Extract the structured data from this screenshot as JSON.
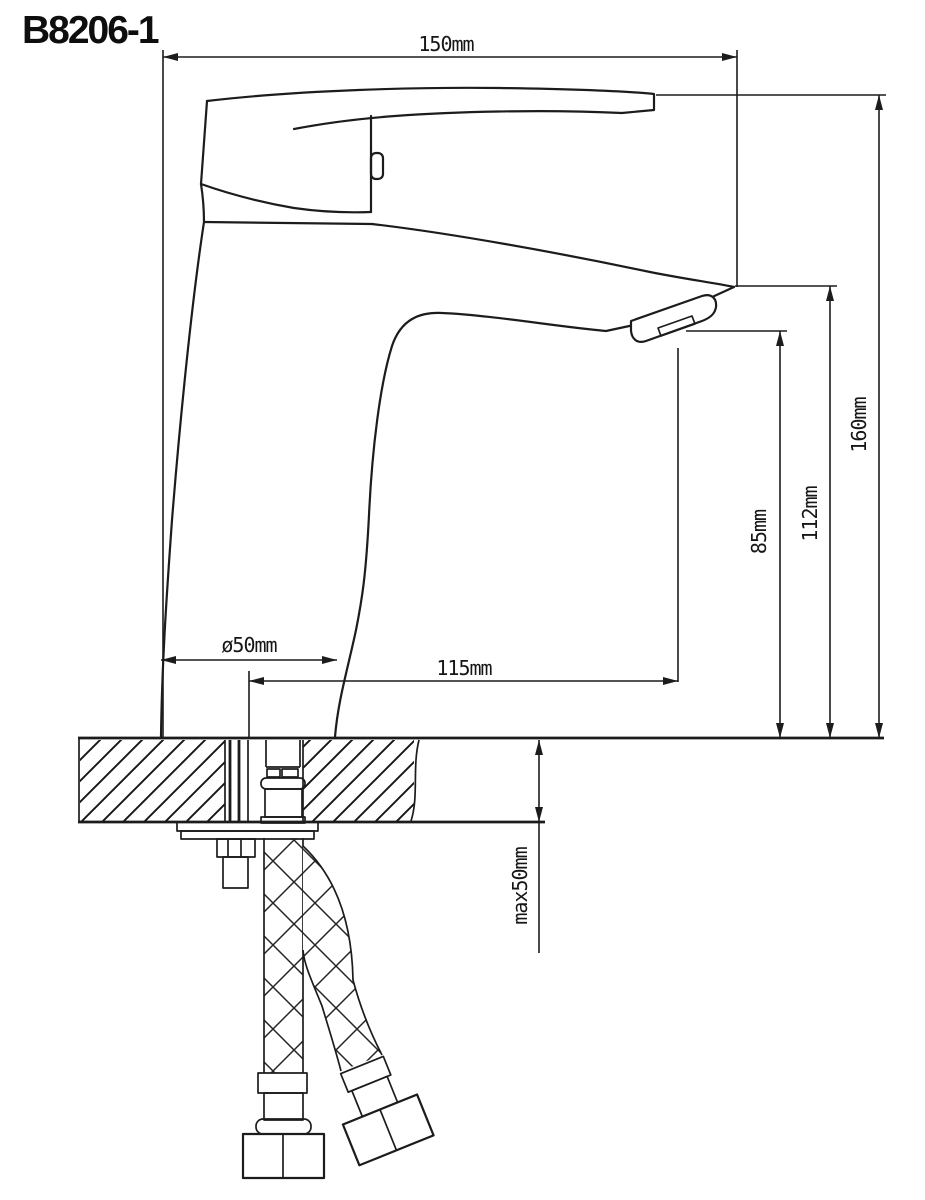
{
  "title": "B8206-1",
  "dimensions": {
    "top_width": "150mm",
    "overall_height": "160mm",
    "spout_tip_height": "112mm",
    "outlet_height": "85mm",
    "base_diameter": "ø50mm",
    "spout_reach": "115mm",
    "max_deck_thickness": "max50mm"
  },
  "colors": {
    "line": "#1c1c1c",
    "background": "#ffffff"
  }
}
